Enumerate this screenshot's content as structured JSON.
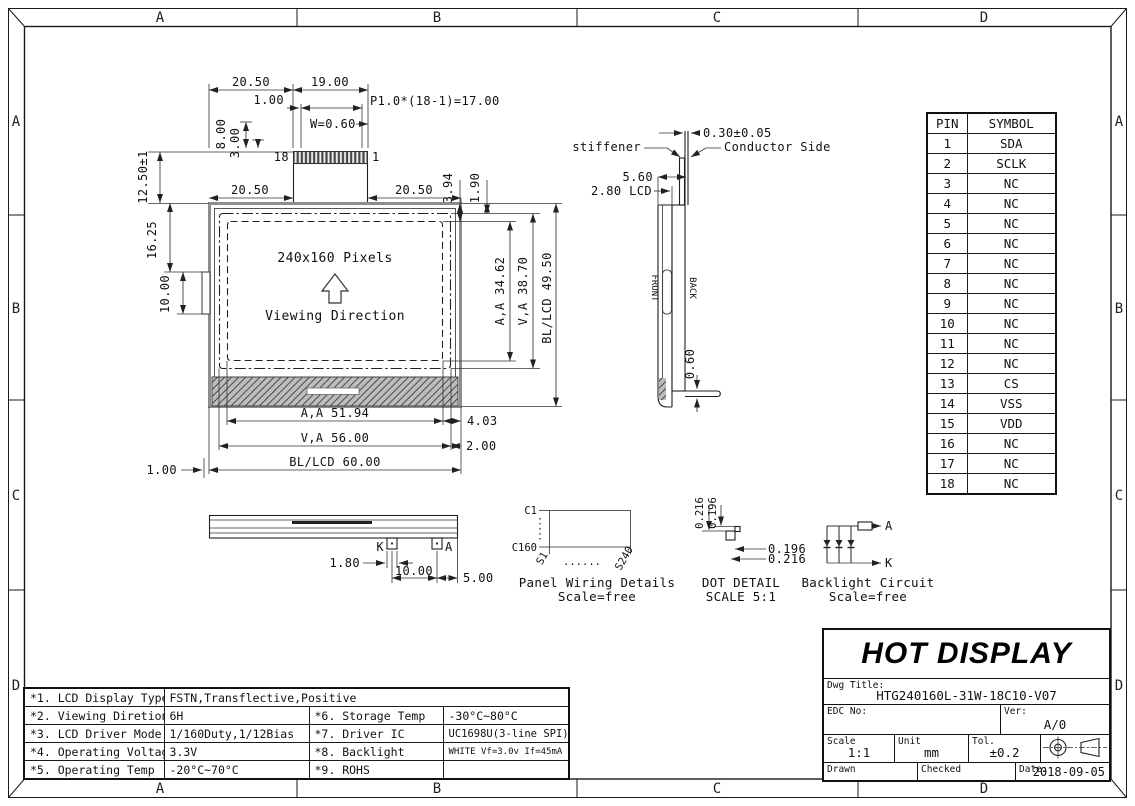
{
  "border": {
    "letters": [
      "A",
      "B",
      "C",
      "D"
    ]
  },
  "front_view": {
    "d2050": "20.50",
    "d1900": "19.00",
    "d100": "1.00",
    "dp10": "P1.0*(18-1)=17.00",
    "dw060": "W=0.60",
    "d800": "8.00",
    "d300": "3.00",
    "d1250": "12.50±1",
    "p18": "18",
    "p1": "1",
    "d1625": "16.25",
    "d1000": "10.00",
    "d394": "3.94",
    "d190": "1.90",
    "daa_v": "A,A 34.62",
    "dva_v": "V,A 38.70",
    "dbl_v": "BL/LCD 49.50",
    "pixels": "240x160 Pixels",
    "viewing": "Viewing Direction",
    "daa_h": "A,A 51.94",
    "d403": "4.03",
    "dva_h": "V,A 56.00",
    "d200": "2.00",
    "dbl_h": "BL/LCD 60.00"
  },
  "side_view": {
    "d030": "0.30±0.05",
    "stiffener": "stiffener",
    "conductor": "Conductor Side",
    "d560": "5.60",
    "d280": "2.80 LCD",
    "front": "FRONT",
    "back": "BACK",
    "d060": "0.60"
  },
  "bottom_view": {
    "k": "K",
    "a": "A",
    "d180": "1.80",
    "d1000": "10.00",
    "d500": "5.00"
  },
  "panel_wiring": {
    "c1": "C1",
    "c160": "C160",
    "s1": "S1",
    "s240": "S240",
    "dots": "......",
    "caption": "Panel Wiring Details",
    "scale": "Scale=free"
  },
  "dot_detail": {
    "v1": "0.216",
    "v2": "0.196",
    "h1": "0.196",
    "h2": "0.216",
    "caption": "DOT DETAIL",
    "scale": "SCALE 5:1"
  },
  "backlight_circuit": {
    "a": "A",
    "k": "K",
    "caption": "Backlight Circuit",
    "scale": "Scale=free"
  },
  "pin_table": {
    "headers": [
      "PIN",
      "SYMBOL"
    ],
    "rows": [
      [
        "1",
        "SDA"
      ],
      [
        "2",
        "SCLK"
      ],
      [
        "3",
        "NC"
      ],
      [
        "4",
        "NC"
      ],
      [
        "5",
        "NC"
      ],
      [
        "6",
        "NC"
      ],
      [
        "7",
        "NC"
      ],
      [
        "8",
        "NC"
      ],
      [
        "9",
        "NC"
      ],
      [
        "10",
        "NC"
      ],
      [
        "11",
        "NC"
      ],
      [
        "12",
        "NC"
      ],
      [
        "13",
        "CS"
      ],
      [
        "14",
        "VSS"
      ],
      [
        "15",
        "VDD"
      ],
      [
        "16",
        "NC"
      ],
      [
        "17",
        "NC"
      ],
      [
        "18",
        "NC"
      ]
    ]
  },
  "spec_table": {
    "rows": [
      [
        "*1. LCD Display Type",
        "FSTN,Transflective,Positive"
      ],
      [
        "*2. Viewing Diretion",
        "6H",
        "*6. Storage Temp",
        "-30°C~80°C"
      ],
      [
        "*3. LCD Driver Mode",
        "1/160Duty,1/12Bias",
        "*7. Driver IC",
        "UC1698U(3-line SPI)"
      ],
      [
        "*4. Operating Voltage",
        "3.3V",
        "*8. Backlight",
        "WHITE Vf=3.0v If=45mA"
      ],
      [
        "*5. Operating Temp",
        "-20°C~70°C",
        "*9. ROHS",
        ""
      ]
    ]
  },
  "title_block": {
    "company": "HOT DISPLAY",
    "dwg_title_label": "Dwg Title:",
    "dwg_title": "HTG240160L-31W-18C10-V07",
    "edc_label": "EDC No:",
    "ver_label": "Ver:",
    "ver": "A/0",
    "scale_label": "Scale",
    "scale": "1:1",
    "unit_label": "Unit",
    "unit": "mm",
    "tol_label": "Tol.",
    "tol": "±0.2",
    "drawn_label": "Drawn",
    "checked_label": "Checked",
    "date_label": "Date:",
    "date": "2018-09-05"
  }
}
